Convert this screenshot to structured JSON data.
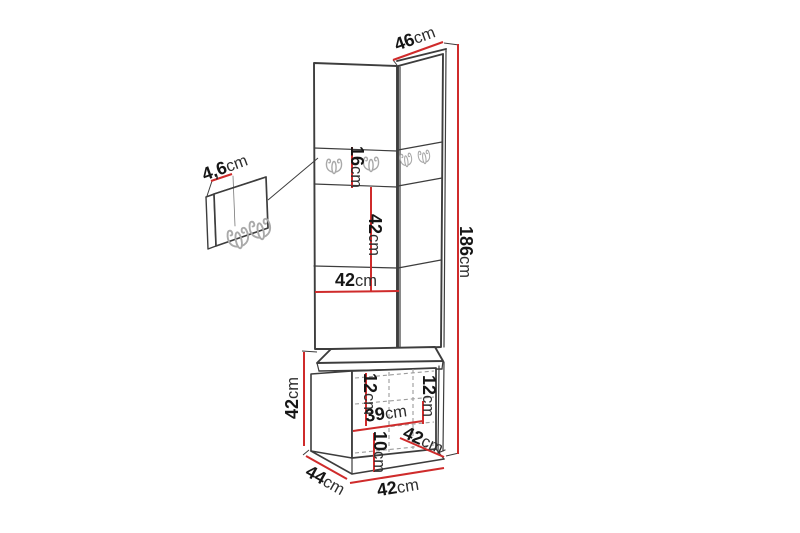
{
  "page": {
    "background": "#ffffff",
    "description": "Technical dimension diagram of a corner hallway furniture set: two tall wall panels with coat hooks, a hook-panel detail callout, and a bench cabinet with seat cushion"
  },
  "colors": {
    "dim": "#cf2b2b",
    "line": "#3d3d3d",
    "text": "#161616",
    "unit_text": "#2e2e2e",
    "hook": "#a9a9a9",
    "dash": "#9c9c9c"
  },
  "dims": {
    "top_width": {
      "value": "46",
      "unit": "cm"
    },
    "total_height": {
      "value": "186",
      "unit": "cm"
    },
    "hook_panel_thickness": {
      "value": "4,6",
      "unit": "cm"
    },
    "hook_row_height": {
      "value": "16",
      "unit": "cm"
    },
    "mid_panel_height": {
      "value": "42",
      "unit": "cm"
    },
    "panel_width": {
      "value": "42",
      "unit": "cm"
    },
    "bench_height": {
      "value": "42",
      "unit": "cm"
    },
    "seat_inset_left": {
      "value": "12",
      "unit": "cm"
    },
    "seat_inset_right": {
      "value": "12",
      "unit": "cm"
    },
    "bench_inner_width": {
      "value": "39",
      "unit": "cm"
    },
    "bottom_section_height": {
      "value": "10",
      "unit": "cm"
    },
    "bench_depth_right": {
      "value": "42",
      "unit": "cm"
    },
    "bench_depth_left": {
      "value": "44",
      "unit": "cm"
    },
    "bench_width": {
      "value": "42",
      "unit": "cm"
    }
  }
}
